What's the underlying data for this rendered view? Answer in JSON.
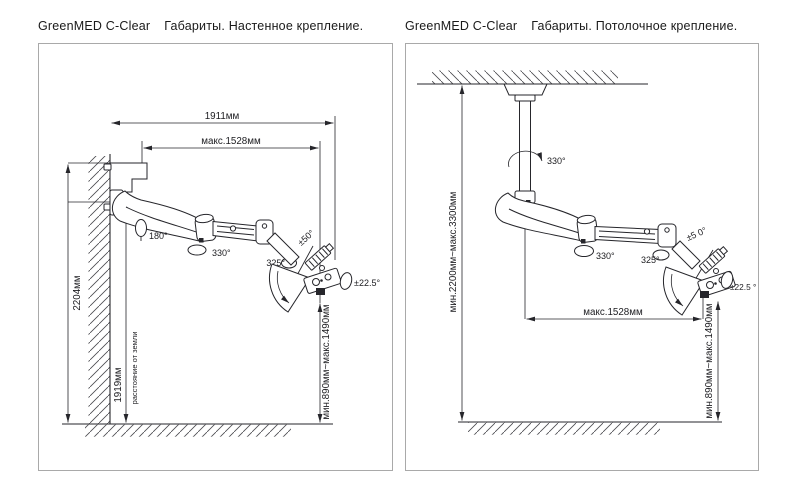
{
  "left": {
    "title_product": "GreenMED C-Clear",
    "title_text": "Габариты. Настенное крепление.",
    "dim_reach": "1911мм",
    "dim_max_ext": "макс.1528мм",
    "dim_mount_height": "2204мм",
    "dim_pivot_height": "1919мм",
    "dim_pivot_note": "расстояние от земли",
    "dim_head_range": "мин.890мм~макс.1490мм",
    "angle_mount": "180°",
    "angle_arm": "330°",
    "angle_spring": "325°",
    "angle_elbow": "±50°",
    "angle_head": "±22.5°"
  },
  "right": {
    "title_product": "GreenMED C-Clear",
    "title_text": "Габариты. Потолочное крепление.",
    "dim_column_range": "мин.2200мм~макс.3300мм",
    "dim_max_ext": "макс.1528мм",
    "dim_head_range": "мин.890мм~макс.1490мм",
    "angle_column": "330°",
    "angle_arm": "330°",
    "angle_spring": "325°",
    "angle_elbow": "±5 0°",
    "angle_head": "±22.5 °"
  },
  "colors": {
    "line": "#26262b",
    "panel_border": "#a9a9a9",
    "background": "#ffffff"
  }
}
